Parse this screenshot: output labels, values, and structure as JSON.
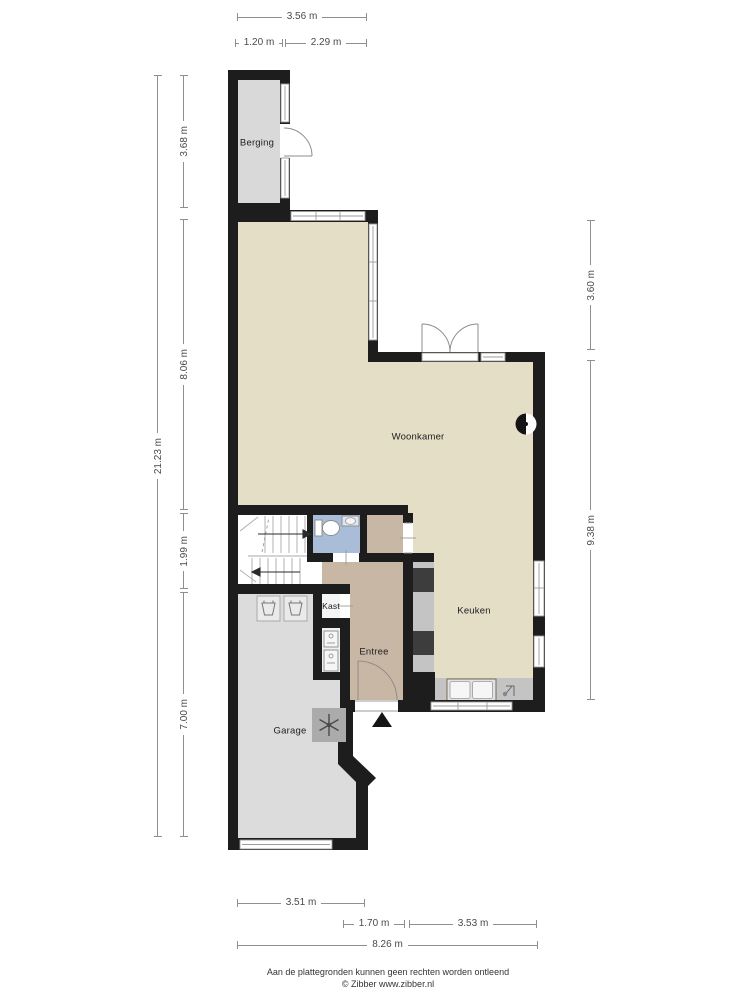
{
  "rooms": {
    "berging": {
      "label": "Berging"
    },
    "woonkamer": {
      "label": "Woonkamer"
    },
    "keuken": {
      "label": "Keuken"
    },
    "kast": {
      "label": "Kast"
    },
    "entree": {
      "label": "Entree"
    },
    "garage": {
      "label": "Garage"
    }
  },
  "dimensions": {
    "top_total": "3.56 m",
    "top_berging": "1.20 m",
    "top_right": "2.29 m",
    "left_total": "21.23 m",
    "left_berging": "3.68 m",
    "left_woonkamer": "8.06 m",
    "left_hal": "1.99 m",
    "left_garage": "7.00 m",
    "right_upper": "3.60 m",
    "right_lower": "9.38 m",
    "bottom_garage": "3.51 m",
    "bottom_entree": "1.70 m",
    "bottom_keuken": "3.53 m",
    "bottom_total": "8.26 m"
  },
  "footer": {
    "disclaimer": "Aan de plattegronden kunnen geen rechten worden ontleend",
    "credit": "© Zibber www.zibber.nl"
  },
  "icons": {
    "stove": "stove-icon",
    "washing_machine": "washing-machine-icon",
    "ventilation_unit": "ventilation-unit-icon",
    "kitchen_sink": "kitchen-sink-icon",
    "faucet": "faucet-icon",
    "toilet": "toilet-icon",
    "bath_sink": "bath-sink-icon",
    "meter_cabinet": "meter-cabinet-icon",
    "entrance_arrow": "entrance-arrow-icon"
  },
  "colors": {
    "wall": "#1d1d1d",
    "floor_living": "#e5dec7",
    "floor_entree": "#c9b7a5",
    "floor_garage": "#dcdcdc",
    "floor_berging": "#d9d9d9",
    "floor_bathroom": "#a9bdd8",
    "counter": "#c4c4c4",
    "appliance": "#3d3d3d",
    "dimension_line": "#8f8f8f"
  }
}
